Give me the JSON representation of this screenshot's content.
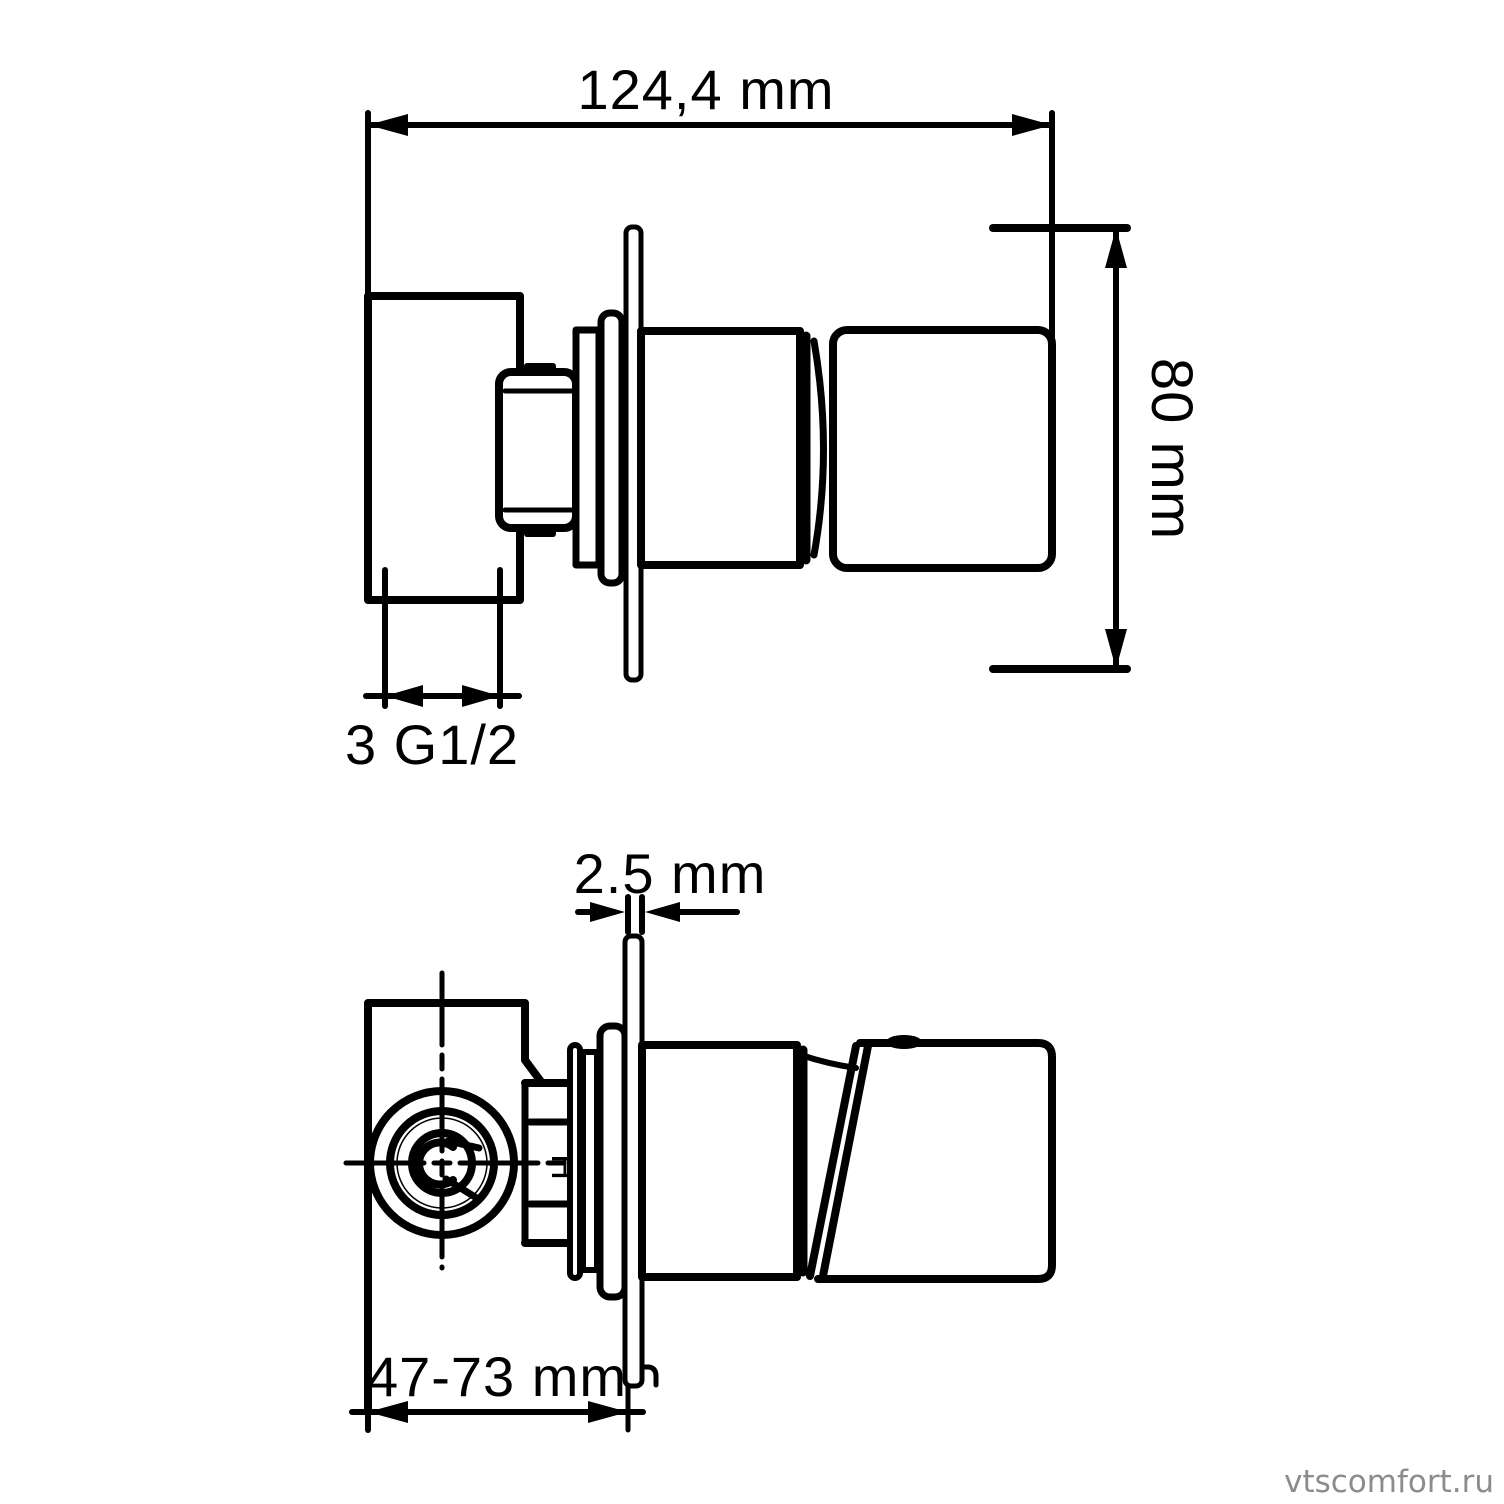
{
  "drawing": {
    "side_view": {
      "width_dim_label": "124,4 mm",
      "height_dim_label": "80 mm",
      "connection_label": "3 G1/2"
    },
    "top_view": {
      "plate_thickness_dim_label": "2.5 mm",
      "depth_range_dim_label": "47-73 mm",
      "hot_marking": "H"
    }
  },
  "watermark": {
    "text": "vtscomfort.ru"
  },
  "colors": {
    "line": "#000000",
    "background": "#ffffff",
    "watermark": "#8c8c8c"
  }
}
